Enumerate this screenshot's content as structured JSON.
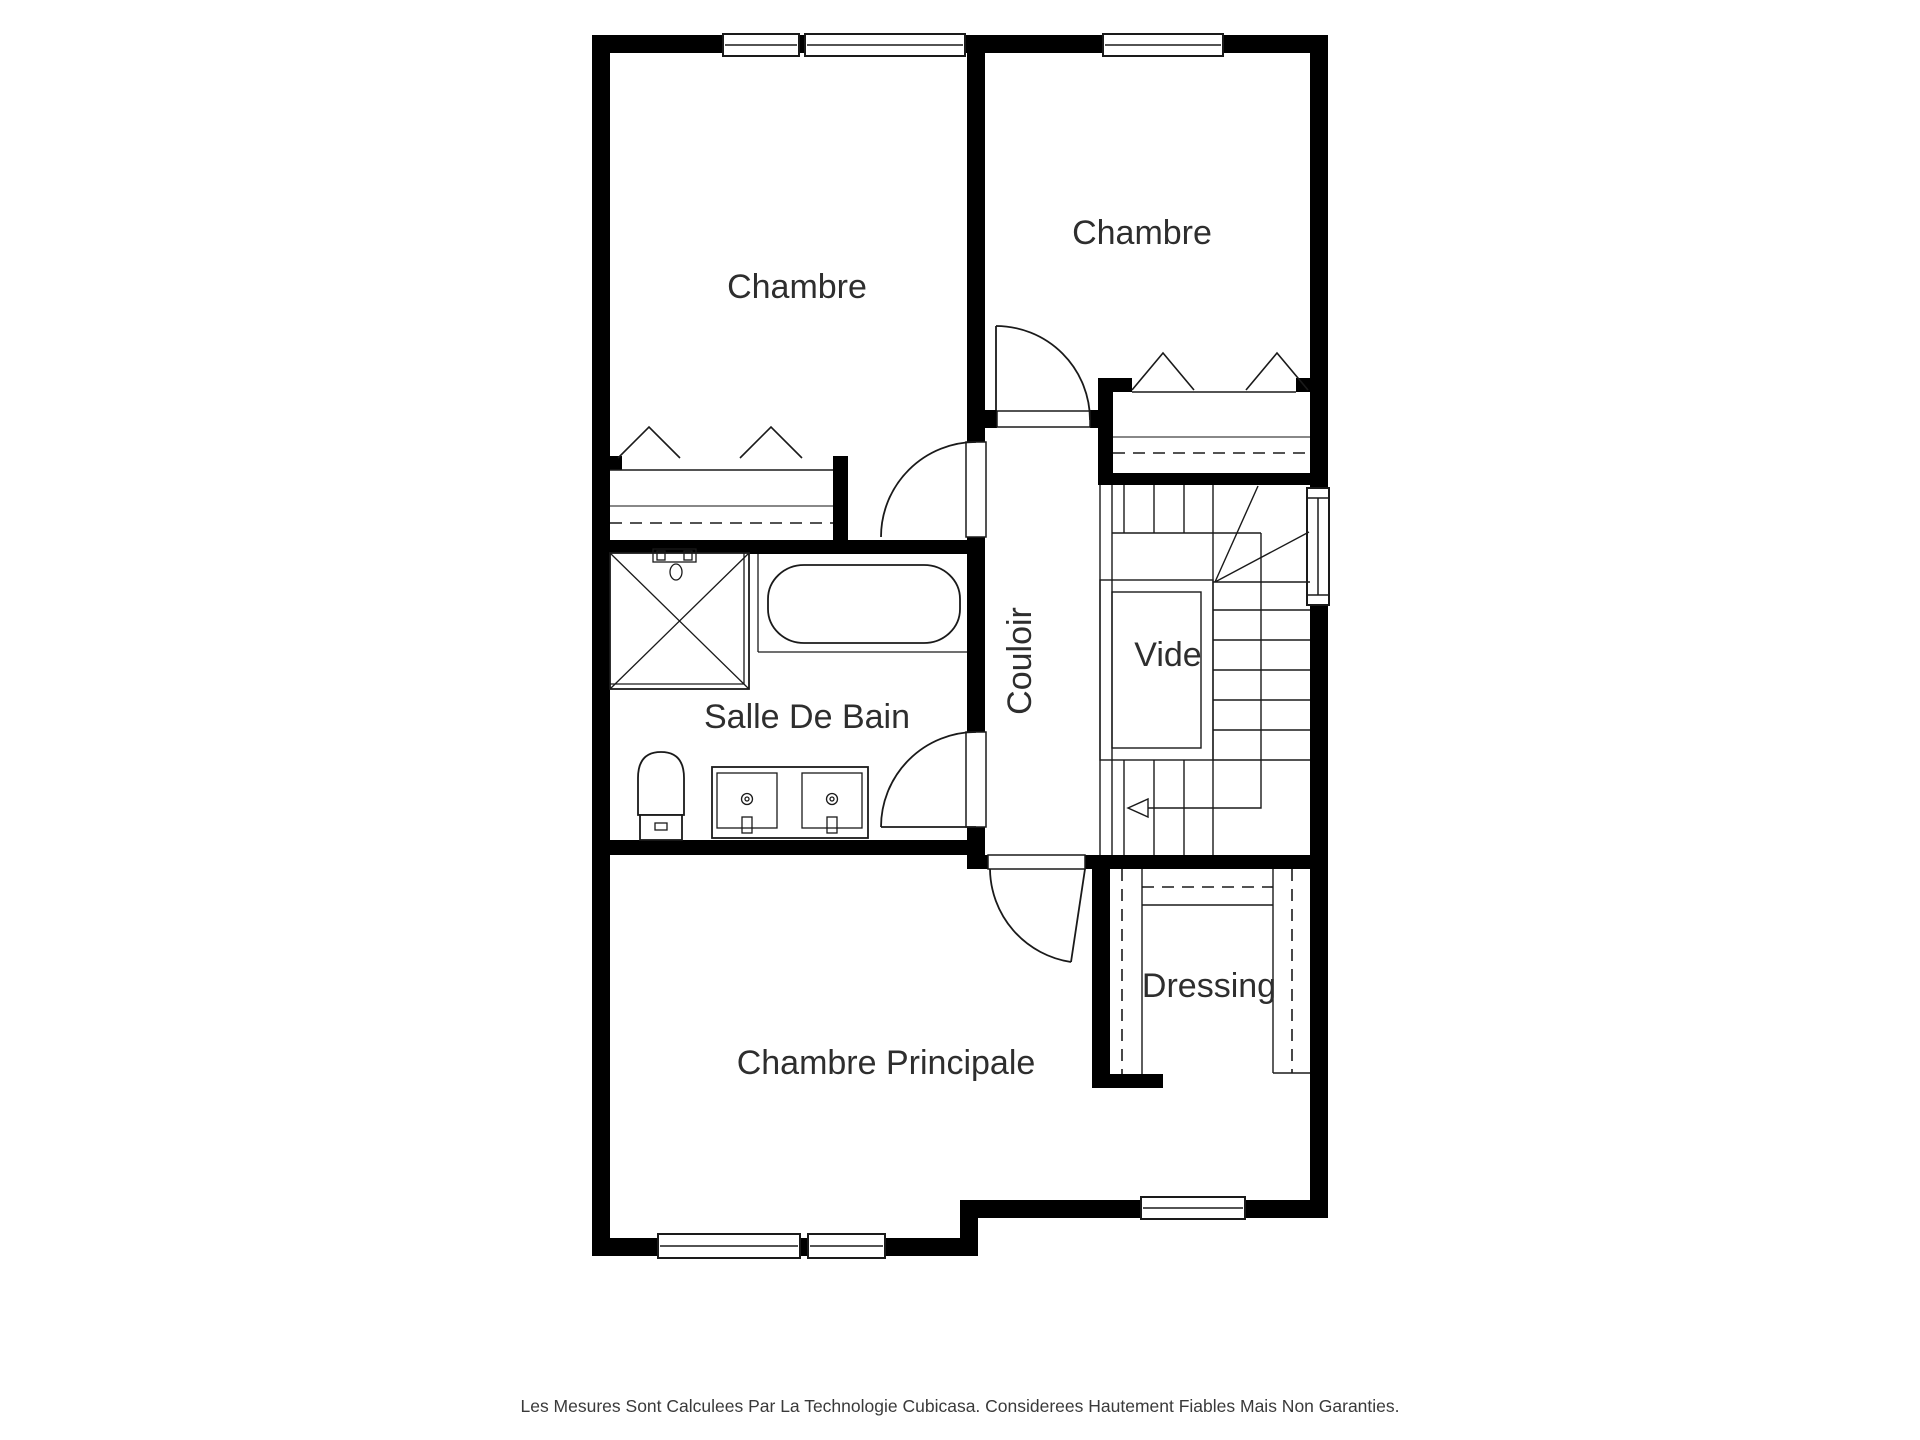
{
  "rooms": {
    "chambre_top_left": "Chambre",
    "chambre_top_right": "Chambre",
    "couloir": "Couloir",
    "vide": "Vide",
    "salle_de_bain": "Salle De Bain",
    "dressing": "Dressing",
    "chambre_principale": "Chambre Principale"
  },
  "footer": {
    "disclaimer": "Les Mesures Sont Calculees Par La Technologie Cubicasa. Considerees Hautement Fiables Mais Non Garanties."
  },
  "colors": {
    "wall": "#000000",
    "bg": "#ffffff",
    "line": "#1a1a1a",
    "shelf": "#606060",
    "label": "#2e2e2e",
    "footer": "#3a3a3a"
  }
}
